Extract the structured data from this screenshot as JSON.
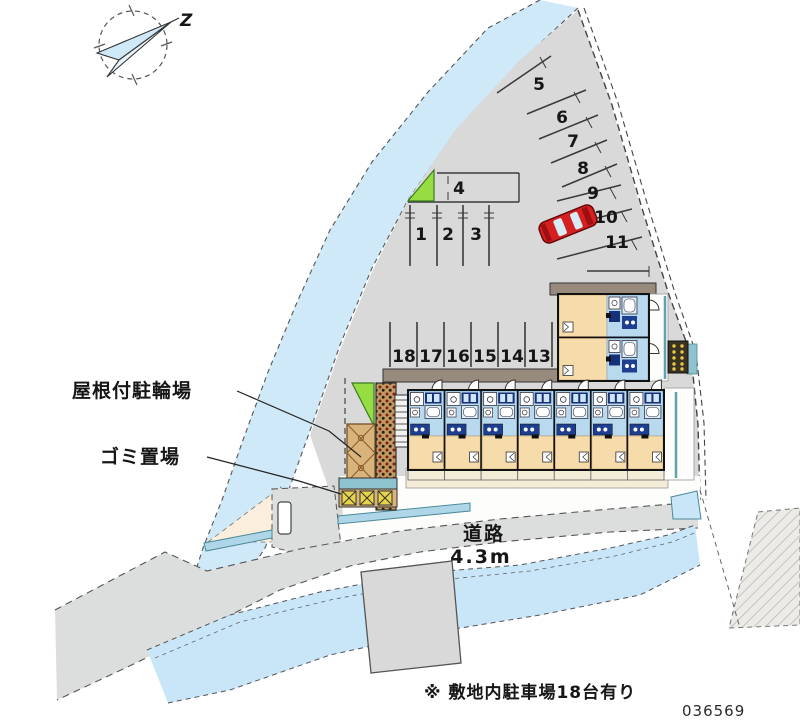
{
  "plan": {
    "id": "036569",
    "note": "※ 敷地内駐車場18台有り"
  },
  "compass": {
    "north_label": "Z"
  },
  "labels": {
    "covered_bicycle_parking": "屋根付駐輪場",
    "garbage_area": "ゴミ置場",
    "road": "道路",
    "road_width": "4.3m"
  },
  "parking": {
    "stalls": [
      "1",
      "2",
      "3",
      "4",
      "5",
      "6",
      "7",
      "8",
      "9",
      "10",
      "11",
      "12",
      "13",
      "14",
      "15",
      "16",
      "17",
      "18"
    ]
  },
  "colors": {
    "site_gray": "#d9d9d9",
    "road_gray": "#dcdddd",
    "river_blue": "#cfe9f8",
    "river_blue_south": "#c8e6f7",
    "unit_room_tan": "#f6dcab",
    "unit_wet_blue": "#b9d9ee",
    "fixture_navy": "#1e3f8f",
    "grass_green": "#96dd44",
    "car_red": "#d42020",
    "roof_brown": "#998a7e",
    "shed_tan": "#c49a5e",
    "teal_edge": "#5fa3ad"
  }
}
